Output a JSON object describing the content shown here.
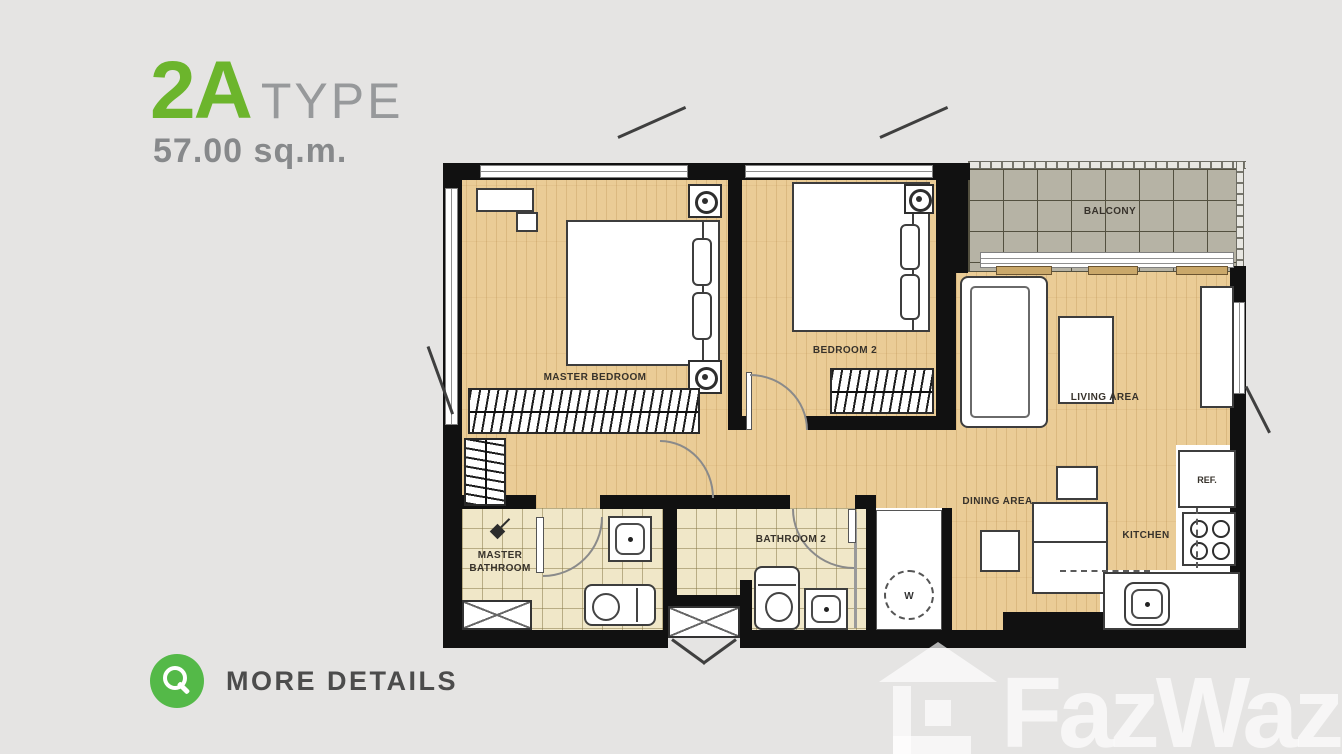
{
  "header": {
    "unit_type": "2A",
    "type_label": "TYPE",
    "area": "57.00 sq.m."
  },
  "plan": {
    "rooms": {
      "master_bedroom": "MASTER BEDROOM",
      "bedroom_2": "BEDROOM 2",
      "balcony": "BALCONY",
      "living_area": "LIVING AREA",
      "dining_area": "DINING AREA",
      "kitchen": "KITCHEN",
      "master_bathroom": "MASTER BATHROOM",
      "bathroom_2": "BATHROOM 2"
    },
    "appliances": {
      "refrigerator": "REF.",
      "washer": "W"
    }
  },
  "footer": {
    "more_details_label": "MORE DETAILS"
  },
  "watermark": {
    "brand": "FazWaz"
  },
  "colors": {
    "accent_green": "#6cb52c",
    "button_green": "#54b948",
    "muted_gray": "#909294",
    "label_dark": "#37322b",
    "wall_black": "#111111",
    "wood_floor": "#eacc96",
    "bath_tile": "#f0e7c8",
    "balcony_tile": "#b6b3a5",
    "background": "#e5e4e3"
  }
}
